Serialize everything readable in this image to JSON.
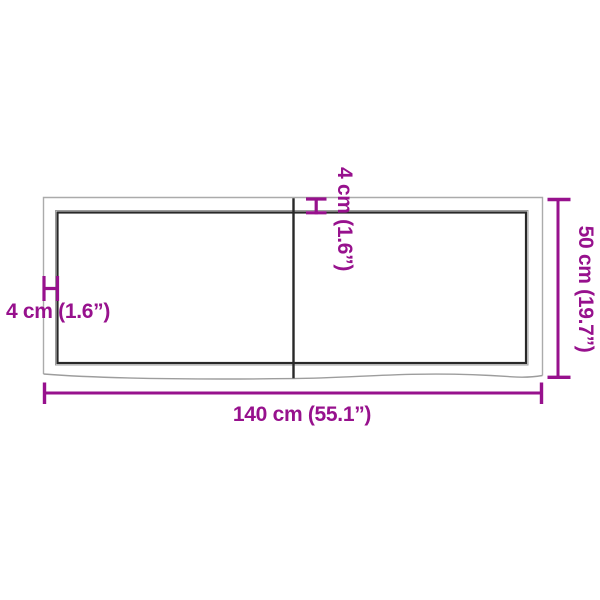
{
  "page": {
    "background": "#ffffff",
    "description": "tabletop dimension diagram"
  },
  "colors": {
    "dimension_accent": "#97118d",
    "board_outline_gray": "#ababab",
    "board_live_edge_gray": "#9d9d9d",
    "board_edge_dark": "#282828"
  },
  "dimensions": {
    "width_label": "140 cm (55.1”)",
    "height_label": "50 cm (19.7”)",
    "thickness_left_label": "4 cm (1.6”)",
    "thickness_top_label": "4 cm (1.6”)"
  }
}
